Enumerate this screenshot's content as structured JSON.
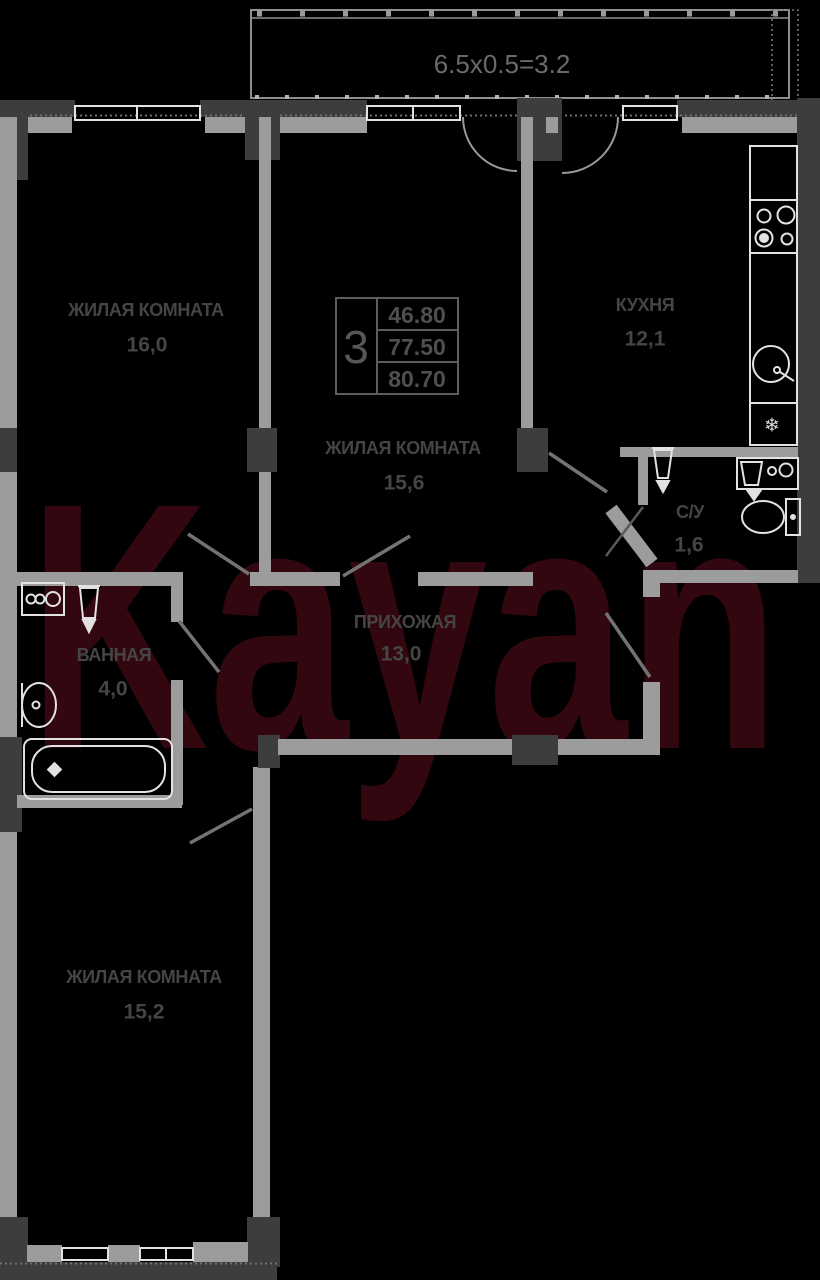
{
  "watermark": {
    "text": "Kayan",
    "color": "#33070f"
  },
  "balcony": {
    "dimension": "6.5х0.5=3.2"
  },
  "info_box": {
    "room_count": "3",
    "areas": [
      "46.80",
      "77.50",
      "80.70"
    ]
  },
  "rooms": {
    "living1": {
      "label": "ЖИЛАЯ КОМНАТА",
      "area": "16,0"
    },
    "living2": {
      "label": "ЖИЛАЯ КОМНАТА",
      "area": "15,6"
    },
    "kitchen": {
      "label": "КУХНЯ",
      "area": "12,1"
    },
    "wc": {
      "label": "С/У",
      "area": "1,6"
    },
    "bathroom": {
      "label": "ВАННАЯ",
      "area": "4,0"
    },
    "hallway": {
      "label": "ПРИХОЖАЯ",
      "area": "13,0"
    },
    "living3": {
      "label": "ЖИЛАЯ КОМНАТА",
      "area": "15,2"
    }
  },
  "icons": {
    "fridge_snowflake": "❄"
  },
  "colors": {
    "wall_dark": "#3d3d3d",
    "wall_light": "#9c9c9c",
    "fixture_line": "#e2e2e2",
    "label_text": "#454545",
    "balcony_text": "#6a6a6a",
    "info_text": "#4f4f4f"
  }
}
